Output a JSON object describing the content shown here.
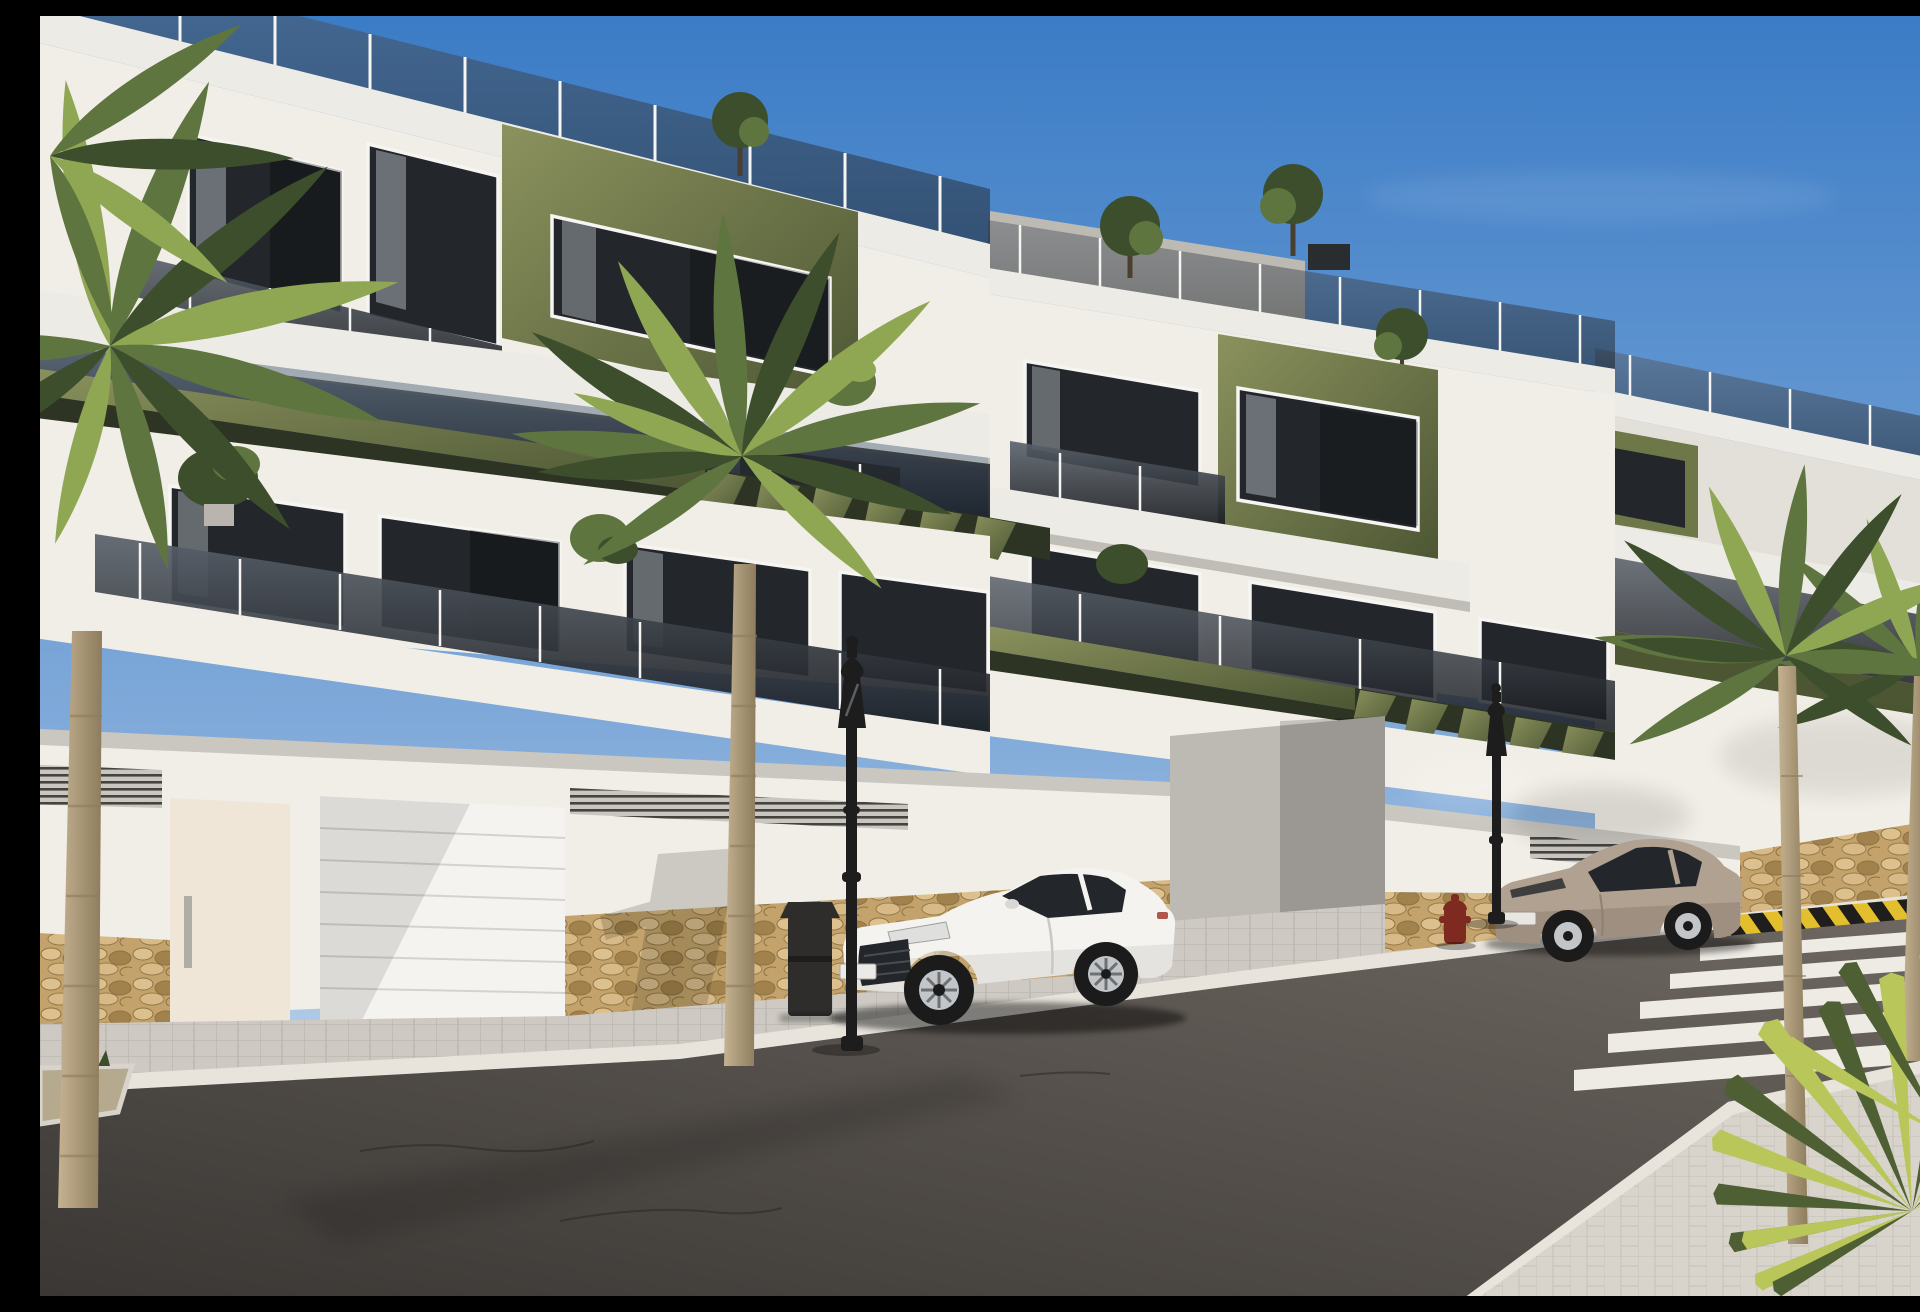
{
  "scene": {
    "type": "architectural-render",
    "description": "Street-level 3D rendering of a modern three-storey Mediterranean apartment complex: white facades with olive-green accent volumes, smoked-glass balcony balustrades, rooftop terraces with glass railings and small trees, garage level with white sectional doors, louvre vents and golden stone base, palm trees along the street, two ornate black lanterns, a litter bin, a red fire hydrant, a parked white coupe and a parked beige coupe, dark asphalt road with zebra crossing, yellow-and-black hazard curb and a light paved walkway with a spiky yucca in the foreground under a blue sky.",
    "objects": {
      "buildings": [
        "left-apartment-block",
        "middle-apartment-block",
        "far-right-apartment-block"
      ],
      "vehicles": [
        "white-coupe-car",
        "beige-coupe-car"
      ],
      "street_furniture": [
        "street-lamp-near",
        "street-lamp-far",
        "litter-bin",
        "fire-hydrant"
      ],
      "vegetation": [
        "left-palm-tree",
        "center-palm-tree",
        "right-palm-trees",
        "foreground-yucca",
        "rooftop-trees",
        "balcony-plants"
      ],
      "road_features": [
        "zebra-crossing",
        "hazard-striped-curb",
        "sidewalk",
        "planter",
        "paved-plaza"
      ]
    }
  },
  "colors": {
    "sky_top": "#3b7cc6",
    "sky_mid": "#7fa9d9",
    "sky_horizon": "#d8e7f3",
    "cloud": "#ffffff",
    "wall_lit": "#f1eee7",
    "wall_base": "#e3e0da",
    "wall_shade": "#bdbab4",
    "wall_warm": "#efe6d8",
    "cornice": "#cac7c1",
    "slab": "#edebe5",
    "slab_shadow": "#b3b0aa",
    "frame_white": "#f6f5f2",
    "glass_top": "#5a616b",
    "glass_bottom": "#16191d",
    "glass_dark": "#23272b",
    "curtain": "#a8adb4",
    "green_lit": "#8b925e",
    "green_mid": "#6d7748",
    "green_dark": "#4c5633",
    "green_under": "#2e3423",
    "stone_bg": "#c3a36b",
    "stone_light": "#dcc08e",
    "stone_dark": "#a2824c",
    "sidewalk": "#cecac3",
    "plaza": "#d9d4cb",
    "curb": "#e8e4dc",
    "road_light": "#6f6862",
    "road_dark": "#3a3734",
    "crosswalk": "#edebe4",
    "hazard_yellow": "#e3bf2e",
    "hazard_black": "#1f1e1c",
    "metal_black": "#1d1d1d",
    "bin_gray": "#2e2d2b",
    "hydrant_red": "#7e2a20",
    "car_white": "#f4f3f0",
    "car_white_shade": "#d9d8d4",
    "car_glass": "#23262a",
    "car_beige": "#b0a190",
    "car_beige_shade": "#8f8172",
    "wheel_dark": "#1b1b1b",
    "rim_light": "#c3c6c9",
    "trunk_light": "#c4b291",
    "trunk_dark": "#8d7c5d",
    "frond_dark": "#3c4e2b",
    "frond_mid": "#5f7540",
    "frond_light": "#8fa653",
    "yucca_light": "#b9c75a",
    "yucca_dark": "#4e5f33",
    "shadow": "#000000"
  }
}
